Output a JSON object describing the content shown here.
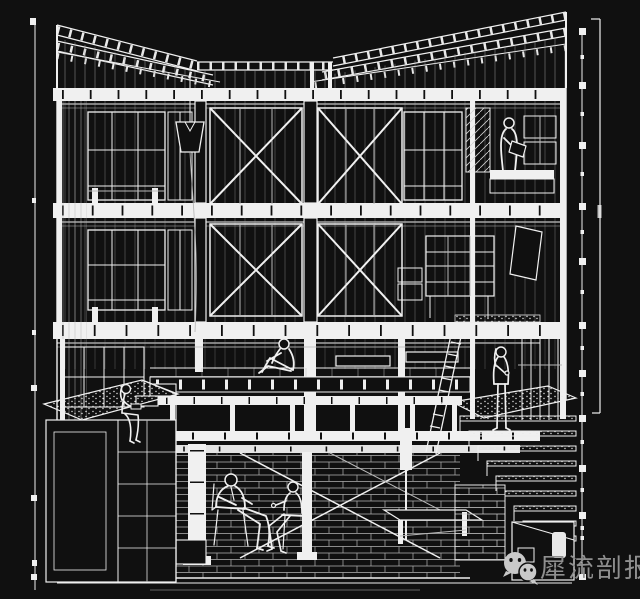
{
  "canvas": {
    "width": 640,
    "height": 599,
    "background": "#101010",
    "ink": "#f0f0f0",
    "alt": "White-on-black sectional perspective line drawing of a three-storey braced timber-frame building with basement, six human figures, planter, stair and margin scale rods"
  },
  "margins": {
    "left_rod": "tick-rod",
    "right_rod": "tick-rod",
    "right_scale_bar": "vertical scale bar with end caps"
  },
  "watermark": {
    "text": "犀流剖报",
    "color": "#8f8f8f",
    "icon_color": "#c9c9c9",
    "icons": [
      "wechat-icon-large",
      "wechat-icon-small"
    ]
  }
}
